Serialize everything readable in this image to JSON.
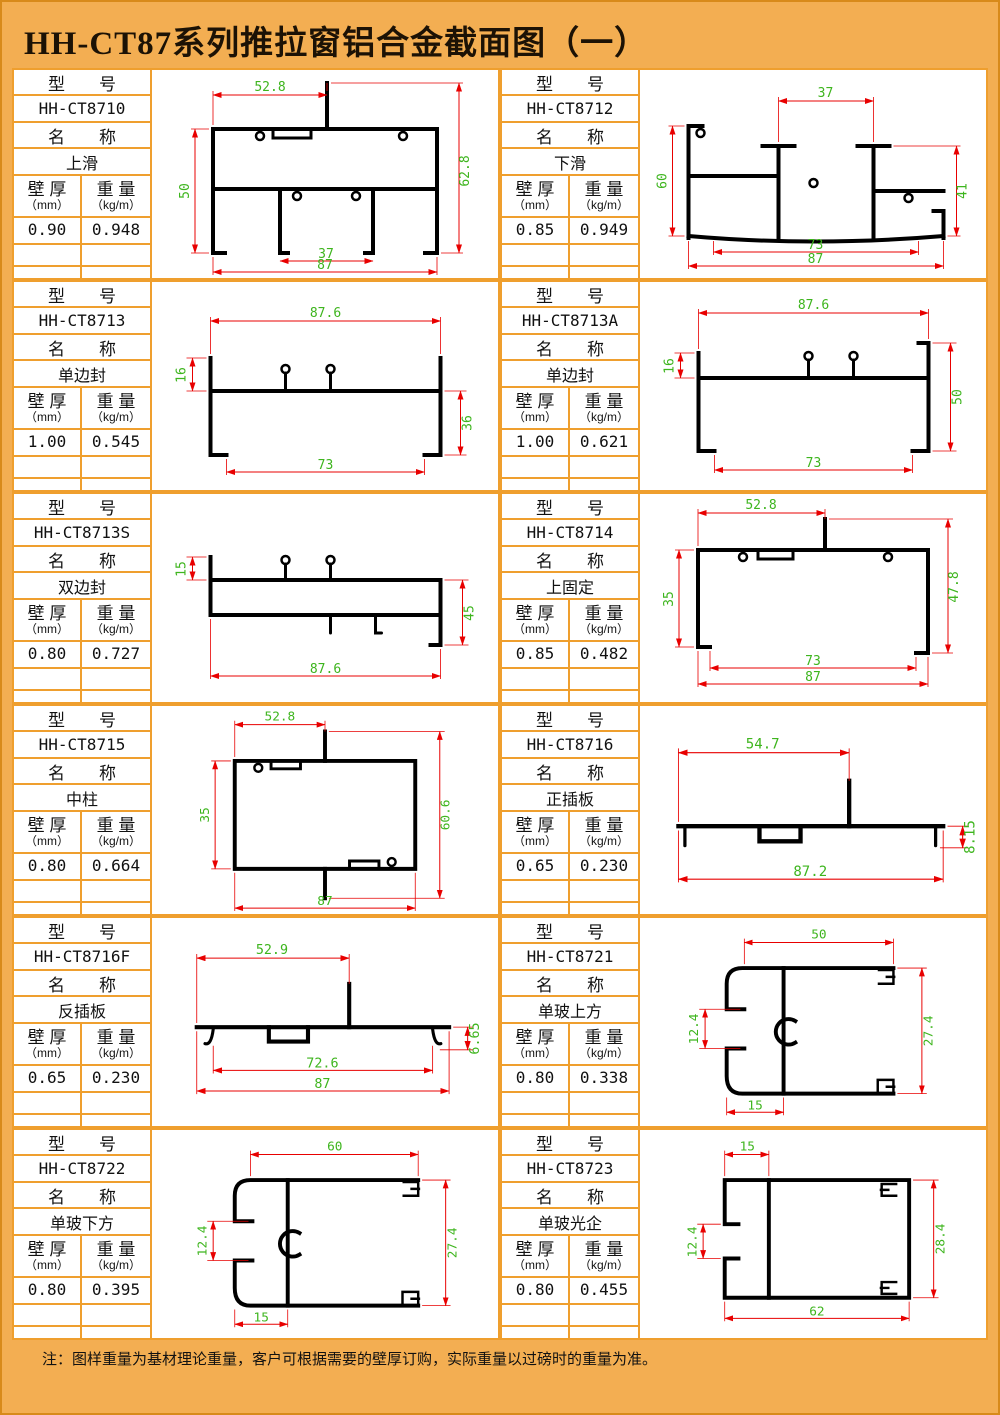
{
  "page": {
    "title": "HH-CT87系列推拉窗铝合金截面图（一）",
    "note": "注：图样重量为基材理论重量，客户可根据需要的壁厚订购，实际重量以过磅时的重量为准。",
    "colors": {
      "background_orange": "#f3ae52",
      "grid_line_orange": "#ef9f2e",
      "dimension_line_red": "#e80000",
      "dimension_text_green": "#3eb51e",
      "profile_black": "#000000"
    }
  },
  "labels": {
    "model": "型　　号",
    "name": "名　　称",
    "thickness": "壁 厚",
    "thickness_unit": "（mm）",
    "weight": "重 量",
    "weight_unit": "（kg/m）"
  },
  "cells": [
    {
      "model": "HH-CT8710",
      "name": "上滑",
      "thickness": "0.90",
      "weight": "0.948",
      "dims": {
        "top": "52.8",
        "left": "50",
        "right": "62.8",
        "inner": "37",
        "bottom": "87"
      }
    },
    {
      "model": "HH-CT8712",
      "name": "下滑",
      "thickness": "0.85",
      "weight": "0.949",
      "dims": {
        "top": "37",
        "left": "60",
        "right": "41",
        "inner": "73",
        "bottom": "87"
      }
    },
    {
      "model": "HH-CT8713",
      "name": "单边封",
      "thickness": "1.00",
      "weight": "0.545",
      "dims": {
        "top": "87.6",
        "left": "16",
        "right": "36",
        "bottom": "73"
      }
    },
    {
      "model": "HH-CT8713A",
      "name": "单边封",
      "thickness": "1.00",
      "weight": "0.621",
      "dims": {
        "top": "87.6",
        "left": "16",
        "right": "50",
        "bottom": "73"
      }
    },
    {
      "model": "HH-CT8713S",
      "name": "双边封",
      "thickness": "0.80",
      "weight": "0.727",
      "dims": {
        "left": "15",
        "right": "45",
        "bottom": "87.6"
      }
    },
    {
      "model": "HH-CT8714",
      "name": "上固定",
      "thickness": "0.85",
      "weight": "0.482",
      "dims": {
        "top": "52.8",
        "left": "35",
        "right": "47.8",
        "inner": "73",
        "bottom": "87"
      }
    },
    {
      "model": "HH-CT8715",
      "name": "中柱",
      "thickness": "0.80",
      "weight": "0.664",
      "dims": {
        "top": "52.8",
        "left": "35",
        "right": "60.6",
        "bottom": "87"
      }
    },
    {
      "model": "HH-CT8716",
      "name": "正插板",
      "thickness": "0.65",
      "weight": "0.230",
      "dims": {
        "top": "54.7",
        "right": "8.15",
        "bottom": "87.2"
      }
    },
    {
      "model": "HH-CT8716F",
      "name": "反插板",
      "thickness": "0.65",
      "weight": "0.230",
      "dims": {
        "top": "52.9",
        "right": "6.65",
        "inner": "72.6",
        "bottom": "87"
      }
    },
    {
      "model": "HH-CT8721",
      "name": "单玻上方",
      "thickness": "0.80",
      "weight": "0.338",
      "dims": {
        "top": "50",
        "left": "12.4",
        "right": "27.4",
        "bottom": "15"
      }
    },
    {
      "model": "HH-CT8722",
      "name": "单玻下方",
      "thickness": "0.80",
      "weight": "0.395",
      "dims": {
        "top": "60",
        "left": "12.4",
        "right": "27.4",
        "bottom": "15"
      }
    },
    {
      "model": "HH-CT8723",
      "name": "单玻光企",
      "thickness": "0.80",
      "weight": "0.455",
      "dims": {
        "top": "15",
        "left": "12.4",
        "right": "28.4",
        "bottom": "62"
      }
    }
  ]
}
